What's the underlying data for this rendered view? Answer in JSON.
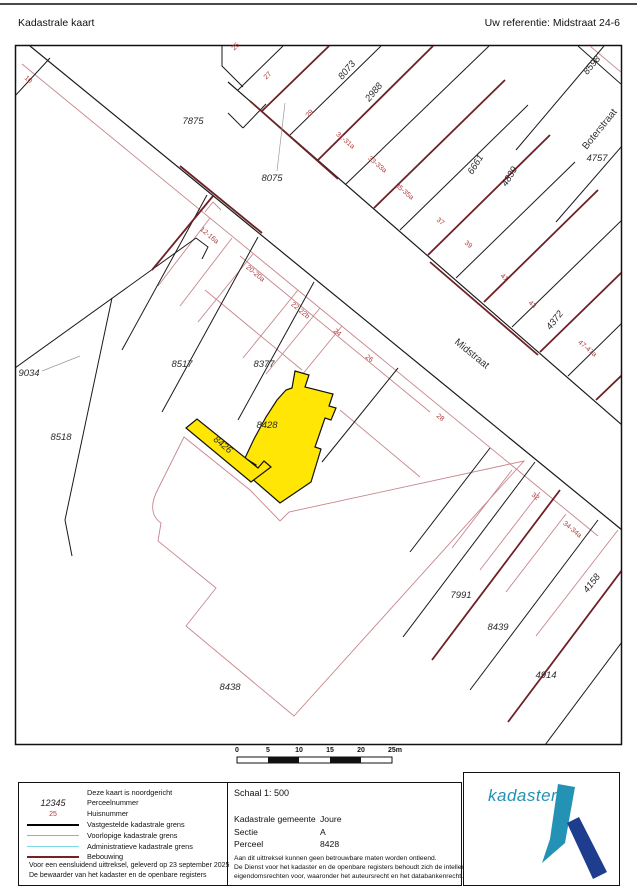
{
  "header": {
    "title": "Kadastrale kaart",
    "reference": "Uw referentie: Midstraat 24-6"
  },
  "map": {
    "highlight_color": "#ffe605",
    "house_number_color": "#b03a3a",
    "line_colors": {
      "vastgesteld": "#1a1a1a",
      "bebouwing_front": "#6d2126",
      "bebouwing_light": "#c8868c",
      "leader": "#9a9a9a"
    },
    "parcel_labels": [
      {
        "text": "7875",
        "x": 193,
        "y": 124,
        "r": 0
      },
      {
        "text": "8075",
        "x": 272,
        "y": 181,
        "r": 0
      },
      {
        "text": "8073",
        "x": 349,
        "y": 72,
        "r": -50
      },
      {
        "text": "2988",
        "x": 376,
        "y": 94,
        "r": -50
      },
      {
        "text": "8598",
        "x": 594,
        "y": 67,
        "r": -50
      },
      {
        "text": "6661",
        "x": 478,
        "y": 166,
        "r": -58
      },
      {
        "text": "4839",
        "x": 512,
        "y": 178,
        "r": -58
      },
      {
        "text": "4757",
        "x": 597,
        "y": 161,
        "r": 0
      },
      {
        "text": "4372",
        "x": 557,
        "y": 322,
        "r": -52
      },
      {
        "text": "8517",
        "x": 182,
        "y": 367,
        "r": 0
      },
      {
        "text": "8377",
        "x": 264,
        "y": 367,
        "r": 0
      },
      {
        "text": "9034",
        "x": 29,
        "y": 376,
        "r": 0
      },
      {
        "text": "8518",
        "x": 61,
        "y": 440,
        "r": 0
      },
      {
        "text": "8428",
        "x": 267,
        "y": 428,
        "r": 0
      },
      {
        "text": "8426",
        "x": 221,
        "y": 447,
        "r": 40
      },
      {
        "text": "8438",
        "x": 230,
        "y": 690,
        "r": 0
      },
      {
        "text": "7991",
        "x": 461,
        "y": 598,
        "r": 0
      },
      {
        "text": "8439",
        "x": 498,
        "y": 630,
        "r": 0
      },
      {
        "text": "4914",
        "x": 546,
        "y": 678,
        "r": 0
      },
      {
        "text": "4158",
        "x": 594,
        "y": 585,
        "r": -52
      }
    ],
    "house_numbers": [
      {
        "text": "10",
        "x": 27,
        "y": 81,
        "r": 40
      },
      {
        "text": "25",
        "x": 237,
        "y": 48,
        "r": -45
      },
      {
        "text": "27",
        "x": 269,
        "y": 77,
        "r": -45
      },
      {
        "text": "29",
        "x": 311,
        "y": 115,
        "r": -45
      },
      {
        "text": "31-31a",
        "x": 344,
        "y": 142,
        "r": 40
      },
      {
        "text": "33-33a",
        "x": 376,
        "y": 166,
        "r": 40
      },
      {
        "text": "35-35a",
        "x": 403,
        "y": 193,
        "r": 40
      },
      {
        "text": "37",
        "x": 439,
        "y": 223,
        "r": 40
      },
      {
        "text": "39",
        "x": 467,
        "y": 246,
        "r": 40
      },
      {
        "text": "41",
        "x": 503,
        "y": 279,
        "r": 40
      },
      {
        "text": "43",
        "x": 531,
        "y": 306,
        "r": 40
      },
      {
        "text": "47-47a",
        "x": 586,
        "y": 350,
        "r": 40
      },
      {
        "text": "12-16a",
        "x": 208,
        "y": 237,
        "r": 40
      },
      {
        "text": "20-20a",
        "x": 254,
        "y": 275,
        "r": 40
      },
      {
        "text": "22-22b",
        "x": 299,
        "y": 312,
        "r": 40
      },
      {
        "text": "24",
        "x": 336,
        "y": 334,
        "r": 40
      },
      {
        "text": "26",
        "x": 368,
        "y": 360,
        "r": 40
      },
      {
        "text": "28",
        "x": 439,
        "y": 419,
        "r": 40
      },
      {
        "text": "32",
        "x": 534,
        "y": 498,
        "r": 40
      },
      {
        "text": "34-34a",
        "x": 571,
        "y": 531,
        "r": 40
      }
    ],
    "street_labels": [
      {
        "text": "Midstraat",
        "x": 470,
        "y": 356,
        "r": 39
      },
      {
        "text": "Boterstraat",
        "x": 602,
        "y": 131,
        "r": -51
      }
    ]
  },
  "scalebar": {
    "ticks": [
      "0",
      "5",
      "10",
      "15",
      "20",
      "25m"
    ]
  },
  "info": {
    "schaal_label": "Schaal 1: 500",
    "rows": [
      {
        "label": "Kadastrale gemeente",
        "value": "Joure"
      },
      {
        "label": "Sectie",
        "value": "A"
      },
      {
        "label": "Perceel",
        "value": "8428"
      }
    ],
    "disclaimer": [
      "Aan dit uittreksel kunnen geen betrouwbare maten worden ontleend.",
      "De Dienst voor het kadaster en de openbare registers behoudt zich de intellectuele",
      "eigendomsrechten voor, waaronder het auteursrecht en het databankenrecht."
    ]
  },
  "legend": {
    "north_note": "Deze kaart is noordgericht",
    "items": [
      {
        "type": "text-italic",
        "symbol": "12345",
        "label": "Perceelnummer"
      },
      {
        "type": "text-red",
        "symbol": "25",
        "label": "Huisnummer"
      },
      {
        "type": "line",
        "color": "#000000",
        "label": "Vastgestelde kadastrale grens"
      },
      {
        "type": "line",
        "color": "#dfae00",
        "label": "Voorlopige kadastrale grens"
      },
      {
        "type": "line",
        "color": "#7fd8e8",
        "label": "Administratieve kadastrale grens"
      },
      {
        "type": "line",
        "color": "#7a2025",
        "label": "Bebouwing"
      }
    ],
    "footer": [
      "Voor een eensluidend uittreksel, geleverd op 23 september 2025",
      "De bewaarder van het kadaster en de openbare registers"
    ]
  },
  "logo": {
    "text": "kadaster"
  }
}
